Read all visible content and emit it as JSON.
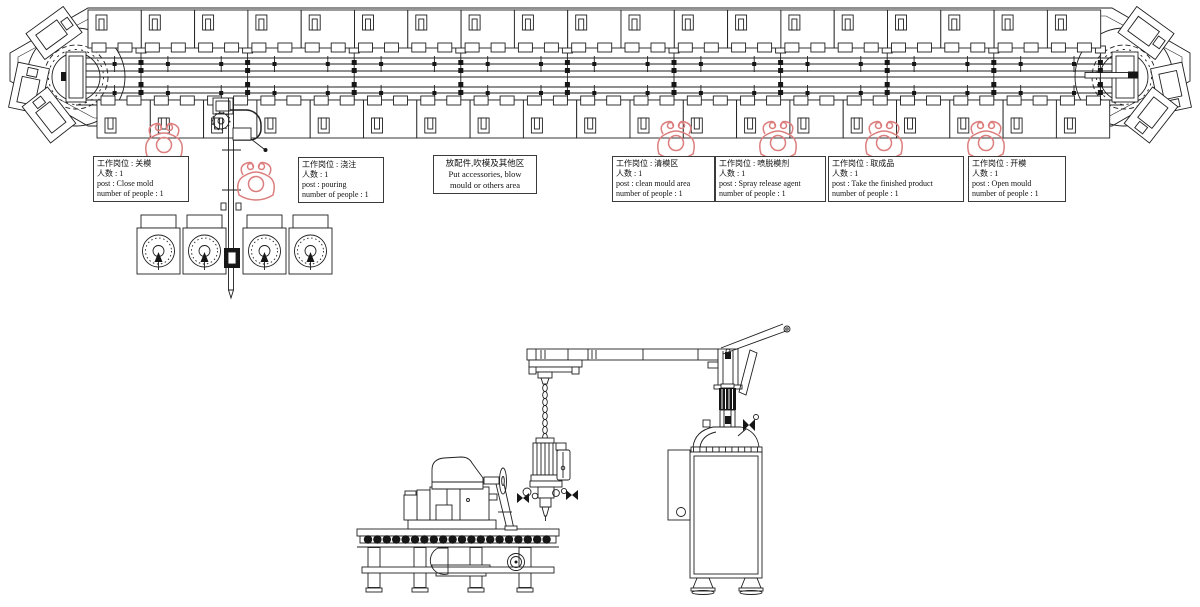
{
  "page": {
    "background": "#ffffff",
    "drawing_color": "#1f1f1f",
    "worker_color": "#dd7e7e"
  },
  "station_labels": [
    {
      "id": "close-mold",
      "lines": [
        "工作岗位 : 关模",
        "人数 : 1",
        "post : Close mold",
        "number of people : 1"
      ]
    },
    {
      "id": "pouring",
      "lines": [
        "工作岗位 : 浇注",
        "人数 : 1",
        "post : pouring",
        "number of people : 1"
      ]
    },
    {
      "id": "clean-mould",
      "lines": [
        "工作岗位 : 清模区",
        "人数 : 1",
        "post : clean mould area",
        "number of people : 1"
      ]
    },
    {
      "id": "spray-release",
      "lines": [
        "工作岗位 : 喷脱模剂",
        "人数 : 1",
        "post : Spray release agent",
        "number of people : 1"
      ]
    },
    {
      "id": "take-product",
      "lines": [
        "工作岗位 : 取成品",
        "人数 : 1",
        "post : Take the finished product",
        "number of people : 1"
      ]
    },
    {
      "id": "open-mould",
      "lines": [
        "工作岗位 : 开模",
        "人数 : 1",
        "post : Open mould",
        "number of people : 1"
      ]
    }
  ],
  "area_note": {
    "lines": [
      "放配件,吹模及其他区",
      "Put accessories, blow",
      "mould or others area"
    ]
  },
  "line_overview": {
    "top_station_count": 19,
    "bottom_station_count": 19,
    "corner_mold_carrier_count": 6,
    "worker_icon_count": 6,
    "tank_unit_count": 4
  }
}
